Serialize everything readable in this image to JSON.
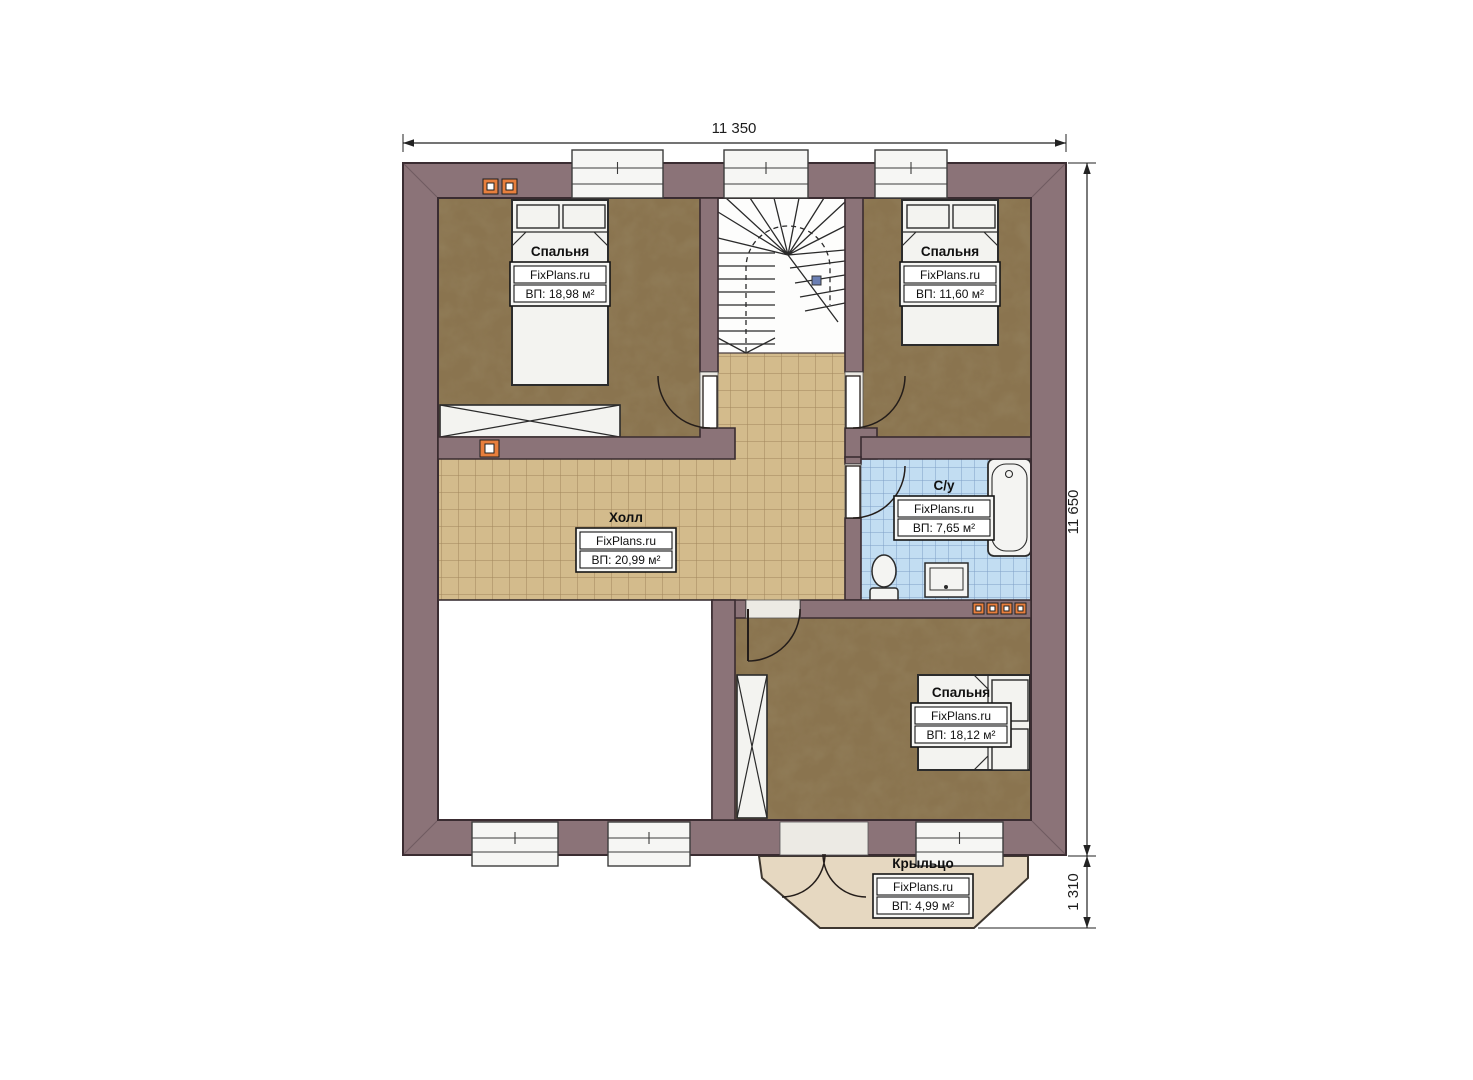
{
  "dimensions": {
    "width_top": "11 350",
    "height_right": "11 650",
    "porch_height": "1 310"
  },
  "rooms": [
    {
      "id": "bedroom-top-left",
      "name": "Спальня",
      "brand": "FixPlans.ru",
      "area": "ВП: 18,98 м²"
    },
    {
      "id": "bedroom-top-right",
      "name": "Спальня",
      "brand": "FixPlans.ru",
      "area": "ВП: 11,60 м²"
    },
    {
      "id": "hall",
      "name": "Холл",
      "brand": "FixPlans.ru",
      "area": "ВП: 20,99 м²"
    },
    {
      "id": "bathroom",
      "name": "С/у",
      "brand": "FixPlans.ru",
      "area": "ВП: 7,65 м²"
    },
    {
      "id": "bedroom-bottom",
      "name": "Спальня",
      "brand": "FixPlans.ru",
      "area": "ВП: 18,12 м²"
    },
    {
      "id": "porch",
      "name": "Крыльцо",
      "brand": "FixPlans.ru",
      "area": "ВП: 4,99 м²"
    }
  ],
  "colors": {
    "wall": "#8b7378",
    "wall_outline": "#3a2c31",
    "bedroom_floor": "#8a744f",
    "hall_tile": "#d3bb8c",
    "bath_tile": "#c2ddf2",
    "porch": "#e6d8c1",
    "vent_orange": "#e87f3d",
    "fixture_fill": "#f3f3f0"
  }
}
